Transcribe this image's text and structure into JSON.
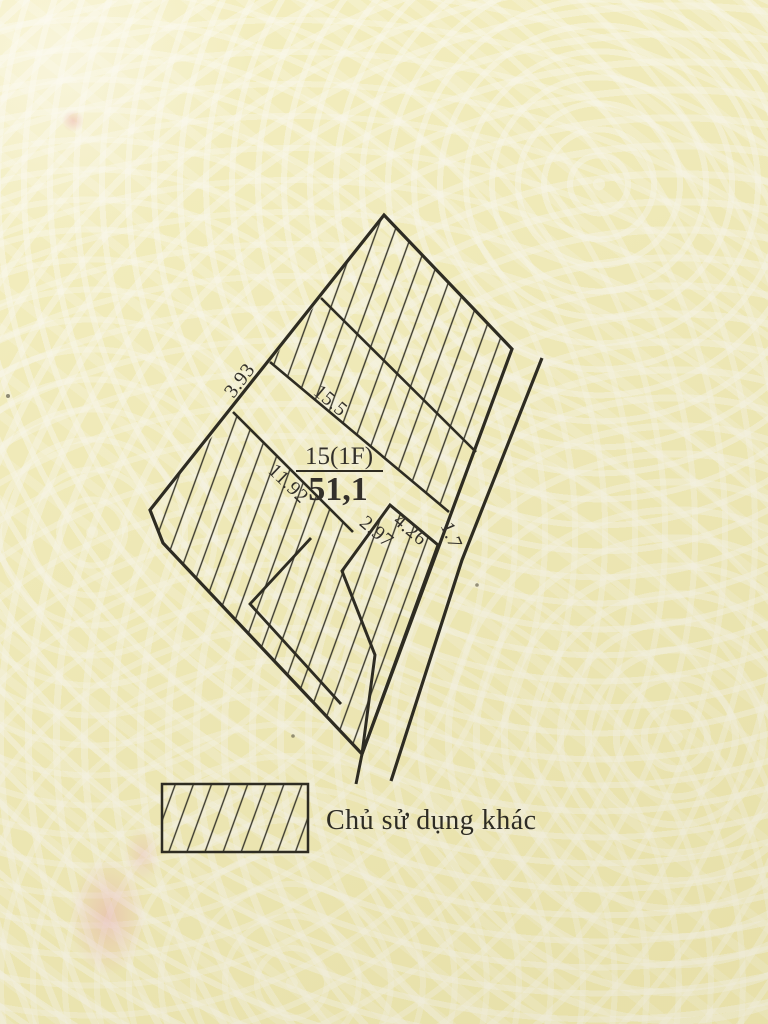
{
  "figure": {
    "parcel": {
      "number": "15(1F)",
      "area": "51,1"
    },
    "measurements": [
      {
        "name": "edge-3-93",
        "value": "3.93"
      },
      {
        "name": "line-15-5",
        "value": "15.5"
      },
      {
        "name": "line-11-92",
        "value": "11.92"
      },
      {
        "name": "edge-2-97",
        "value": "2.97"
      },
      {
        "name": "edge-4-26",
        "value": "4.26"
      },
      {
        "name": "edge-1-7",
        "value": "1.7"
      }
    ]
  },
  "legend": {
    "label": "Chủ sử dụng khác",
    "swatch": "hatched-rectangle"
  },
  "colors": {
    "paper": "#f3edb8",
    "pattern_white": "#fbf9ec",
    "ink": "#2e2c22",
    "hatch": "#3a382c",
    "pink_smudge": "#eaa0b4"
  }
}
